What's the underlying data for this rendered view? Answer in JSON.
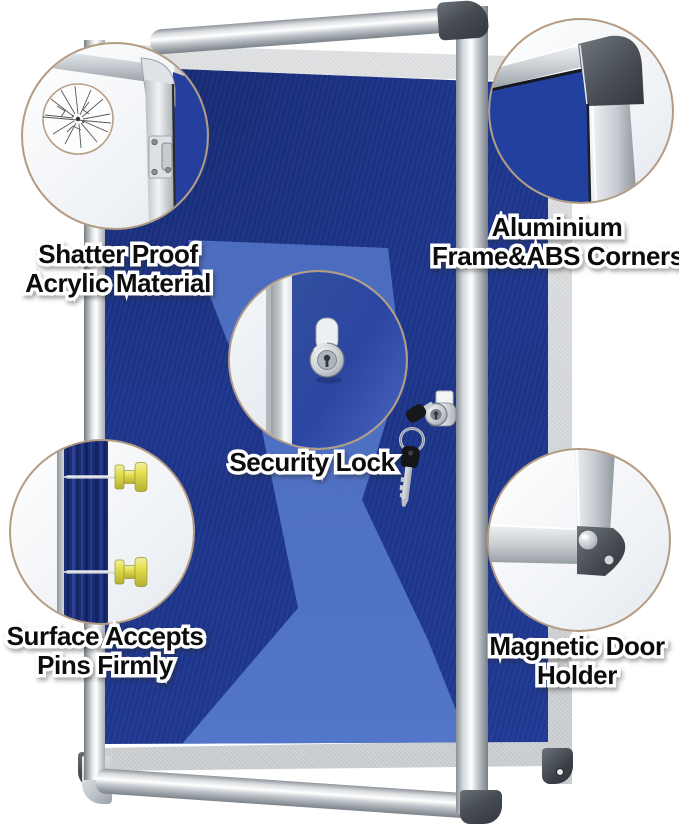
{
  "product": {
    "callouts": [
      {
        "id": "shatter-proof",
        "line1": "Shatter Proof",
        "line2": "Acrylic Material"
      },
      {
        "id": "aluminium-corners",
        "line1": "Aluminium",
        "line2": "Frame&ABS Corners"
      },
      {
        "id": "security-lock",
        "line1": "Security Lock"
      },
      {
        "id": "pins-surface",
        "line1": "Surface Accepts",
        "line2": "Pins Firmly"
      },
      {
        "id": "magnetic-holder",
        "line1": "Magnetic Door",
        "line2": "Holder"
      }
    ],
    "colors": {
      "felt_blue": "#1c3488",
      "glare_blue": "#4e6fc4",
      "frame_silver": "#d4d6d8",
      "abs_corner_dark": "#41464c",
      "callout_ring_tan": "#b49c82",
      "pin_yellow": "#e4e050",
      "label_text": "#0c0c0c",
      "label_outline": "#ffffff"
    }
  }
}
